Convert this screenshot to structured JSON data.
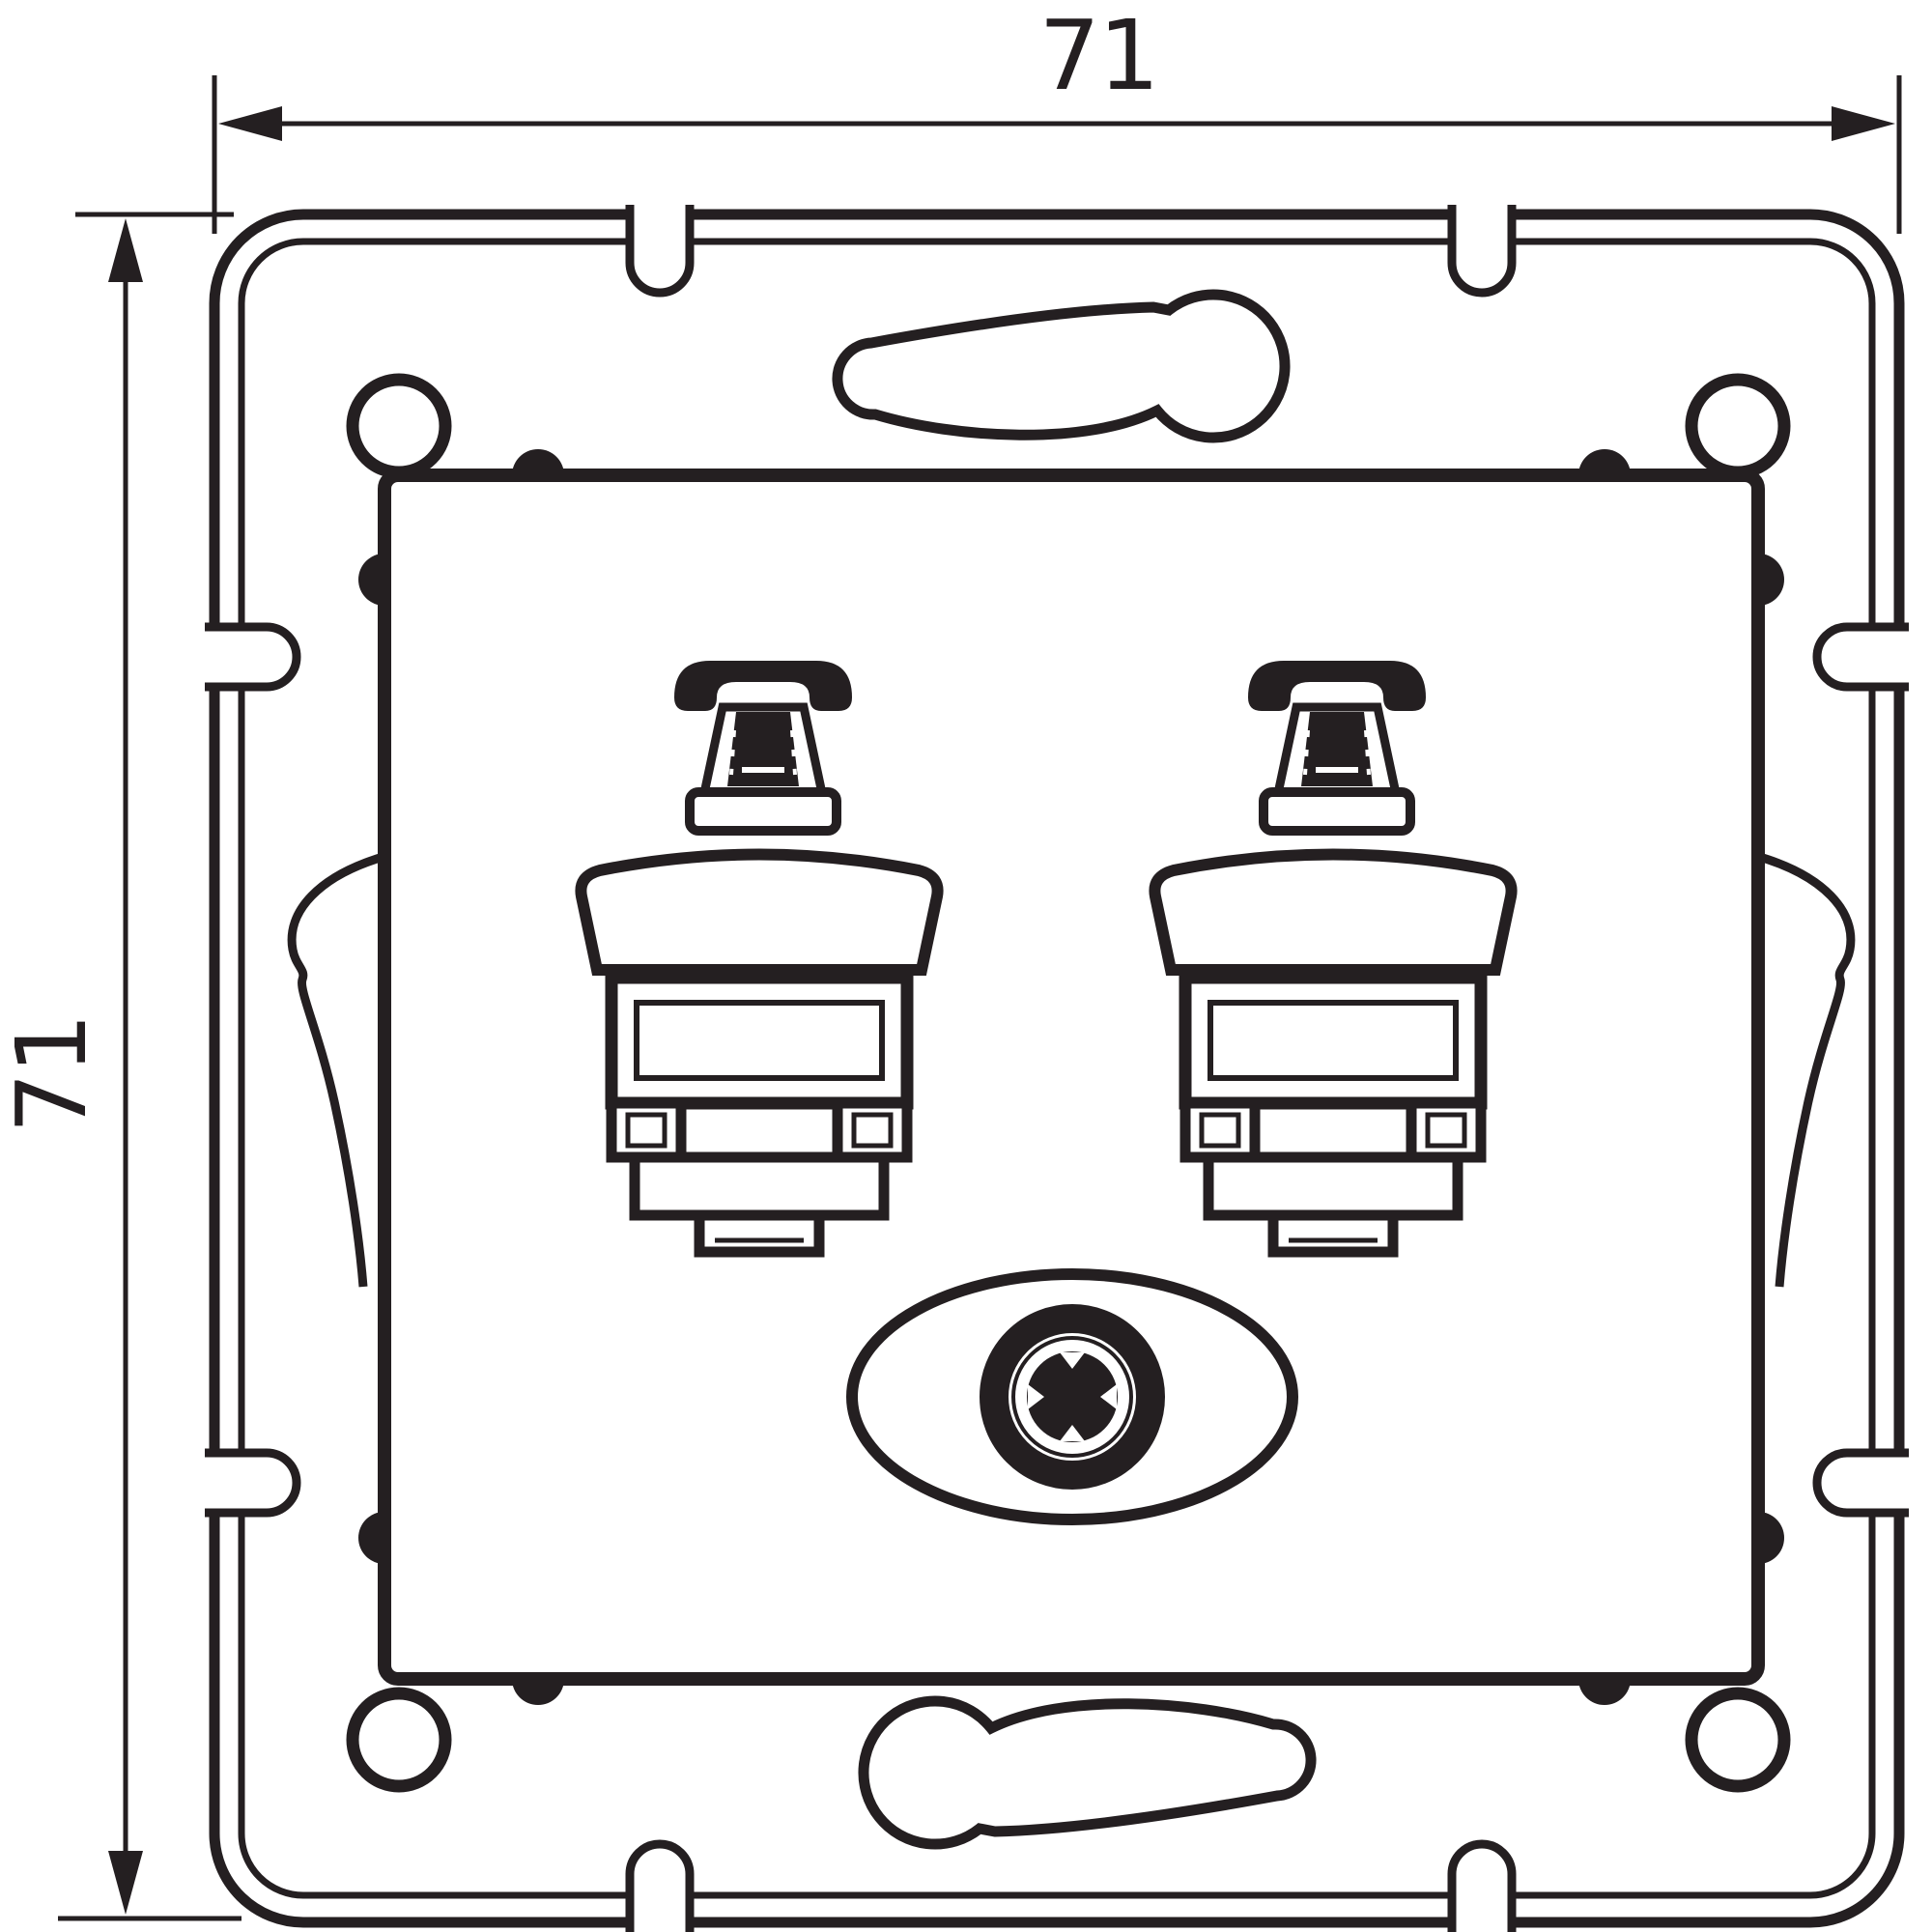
{
  "figure": {
    "type": "technical dimension drawing",
    "subject": "double telephone / RJ socket insert with mounting frame, front view"
  },
  "colors": {
    "line": "#241f21",
    "background": "#ffffff"
  },
  "dimensions": {
    "width_label": "71",
    "height_label": "71"
  },
  "components": {
    "mounting_frame": "square metal claw frame with rounded corners",
    "corner_holes": 4,
    "edge_notches": 8,
    "keyhole_slots": 2,
    "side_claws": 2,
    "socket_modules": 2,
    "socket_icon": "telephone-icon",
    "socket_jack": "rj-keystone-jack",
    "center_feature": "oval recess with cross-head fixing screw"
  }
}
